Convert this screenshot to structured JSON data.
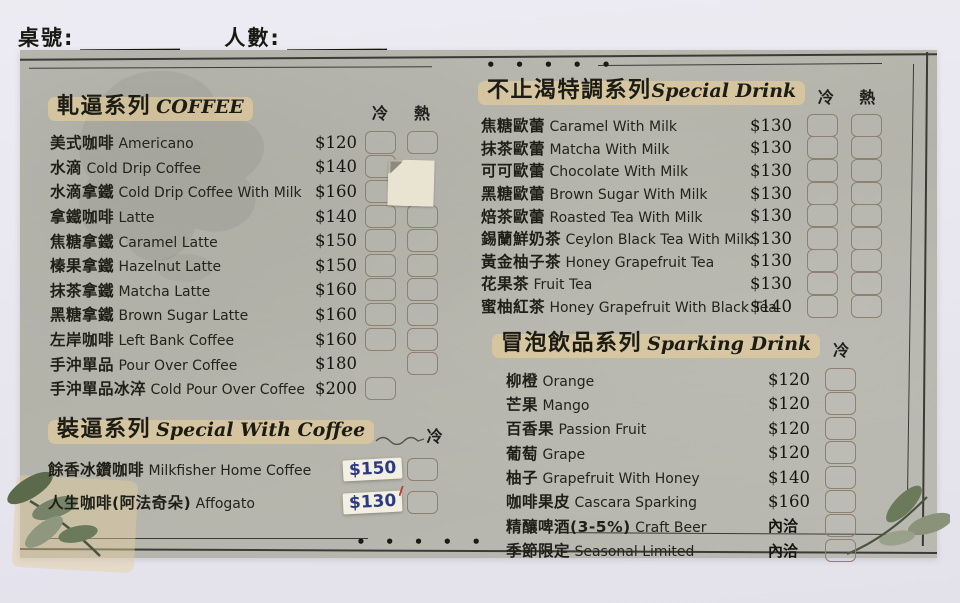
{
  "header": {
    "table_label": "桌號:",
    "people_label": "人數:"
  },
  "decor": {
    "dots": "• • • • •"
  },
  "colors": {
    "paper": "#b8b7ae",
    "background": "#e8e6ed",
    "ink": "#26261f",
    "checkbox_border": "#8d8171",
    "title_highlight": "#e9ce97",
    "sticker_background": "#f4f0e1",
    "sticker_ink": "#2b3a82",
    "leaf_green": "#6d7a5c"
  },
  "sections": [
    {
      "id": "coffee",
      "title_zh": "軋逼系列",
      "title_en": "COFFEE",
      "cols": [
        "冷",
        "熱"
      ],
      "items": [
        {
          "zh": "美式咖啡",
          "en": "Americano",
          "price": "$120",
          "cold": true,
          "hot": true
        },
        {
          "zh": "水滴",
          "en": "Cold Drip Coffee",
          "price": "$140",
          "cold": true,
          "hot": false,
          "covered_by_patch": true
        },
        {
          "zh": "水滴拿鐵",
          "en": "Cold Drip Coffee With Milk",
          "price": "$160",
          "cold": true,
          "hot": false,
          "covered_by_patch": true
        },
        {
          "zh": "拿鐵咖啡",
          "en": "Latte",
          "price": "$140",
          "cold": true,
          "hot": true
        },
        {
          "zh": "焦糖拿鐵",
          "en": "Caramel Latte",
          "price": "$150",
          "cold": true,
          "hot": true
        },
        {
          "zh": "榛果拿鐵",
          "en": "Hazelnut Latte",
          "price": "$150",
          "cold": true,
          "hot": true
        },
        {
          "zh": "抹茶拿鐵",
          "en": "Matcha Latte",
          "price": "$160",
          "cold": true,
          "hot": true
        },
        {
          "zh": "黑糖拿鐵",
          "en": "Brown Sugar Latte",
          "price": "$160",
          "cold": true,
          "hot": true
        },
        {
          "zh": "左岸咖啡",
          "en": "Left Bank Coffee",
          "price": "$160",
          "cold": true,
          "hot": true
        },
        {
          "zh": "手沖單品",
          "en": "Pour Over Coffee",
          "price": "$180",
          "cold": false,
          "hot": true
        },
        {
          "zh": "手沖單品冰淬",
          "en": "Cold Pour Over Coffee",
          "price": "$200",
          "cold": true,
          "hot": false
        }
      ]
    },
    {
      "id": "special_coffee",
      "title_zh": "裝逼系列",
      "title_en": "Special With Coffee",
      "cols": [
        "冷"
      ],
      "items": [
        {
          "zh": "餘香冰鑽咖啡",
          "en": "Milkfisher Home Coffee",
          "price": "$150",
          "price_sticker": true,
          "cold": true
        },
        {
          "zh": "人生咖啡(阿法奇朵)",
          "en": "Affogato",
          "price": "$130",
          "price_sticker": true,
          "cold": true
        }
      ]
    },
    {
      "id": "special_drink",
      "title_zh": "不止渴特調系列",
      "title_en": "Special Drink",
      "cols": [
        "冷",
        "熱"
      ],
      "items": [
        {
          "zh": "焦糖歐蕾",
          "en": "Caramel With Milk",
          "price": "$130",
          "cold": true,
          "hot": true
        },
        {
          "zh": "抹茶歐蕾",
          "en": "Matcha With Milk",
          "price": "$130",
          "cold": true,
          "hot": true
        },
        {
          "zh": "可可歐蕾",
          "en": "Chocolate With Milk",
          "price": "$130",
          "cold": true,
          "hot": true
        },
        {
          "zh": "黑糖歐蕾",
          "en": "Brown Sugar With Milk",
          "price": "$130",
          "cold": true,
          "hot": true
        },
        {
          "zh": "焙茶歐蕾",
          "en": "Roasted Tea With Milk",
          "price": "$130",
          "cold": true,
          "hot": true
        },
        {
          "zh": "錫蘭鮮奶茶",
          "en": "Ceylon Black Tea With Milk",
          "price": "$130",
          "cold": true,
          "hot": true
        },
        {
          "zh": "黃金柚子茶",
          "en": "Honey Grapefruit Tea",
          "price": "$130",
          "cold": true,
          "hot": true
        },
        {
          "zh": "花果茶",
          "en": "Fruit Tea",
          "price": "$130",
          "cold": true,
          "hot": true
        },
        {
          "zh": "蜜柚紅茶",
          "en": "Honey Grapefruit With Black Tea",
          "price": "$140",
          "cold": true,
          "hot": true
        }
      ]
    },
    {
      "id": "sparking",
      "title_zh": "冒泡飲品系列",
      "title_en": "Sparking Drink",
      "cols": [
        "冷"
      ],
      "items": [
        {
          "zh": "柳橙",
          "en": "Orange",
          "price": "$120",
          "cold": true
        },
        {
          "zh": "芒果",
          "en": "Mango",
          "price": "$120",
          "cold": true
        },
        {
          "zh": "百香果",
          "en": "Passion Fruit",
          "price": "$120",
          "cold": true
        },
        {
          "zh": "葡萄",
          "en": "Grape",
          "price": "$120",
          "cold": true
        },
        {
          "zh": "柚子",
          "en": "Grapefruit With Honey",
          "price": "$140",
          "cold": true
        },
        {
          "zh": "咖啡果皮",
          "en": "Cascara Sparking",
          "price": "$160",
          "cold": true
        },
        {
          "zh": "精釀啤酒(3-5%)",
          "en": "Craft Beer",
          "price": "內洽",
          "ask": true,
          "cold": true
        },
        {
          "zh": "季節限定",
          "en": "Seasonal Limited",
          "price": "內洽",
          "ask": true,
          "cold": true
        }
      ]
    }
  ]
}
